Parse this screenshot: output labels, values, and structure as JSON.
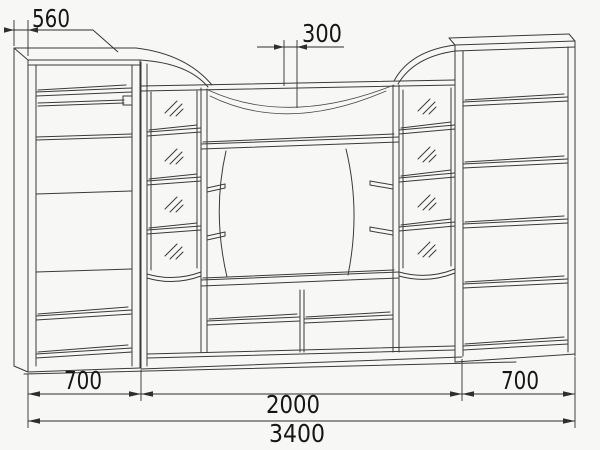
{
  "drawing": {
    "title_semantic": "wall-unit-furniture-technical-drawing",
    "colors": {
      "background": "#f7f7f5",
      "line": "#3a3a3a",
      "dimension_text": "#161616"
    },
    "dimensions": {
      "depth": "560",
      "top_gap": "300",
      "left_width": "700",
      "center_width": "2000",
      "right_width": "700",
      "total_width": "3400"
    }
  }
}
